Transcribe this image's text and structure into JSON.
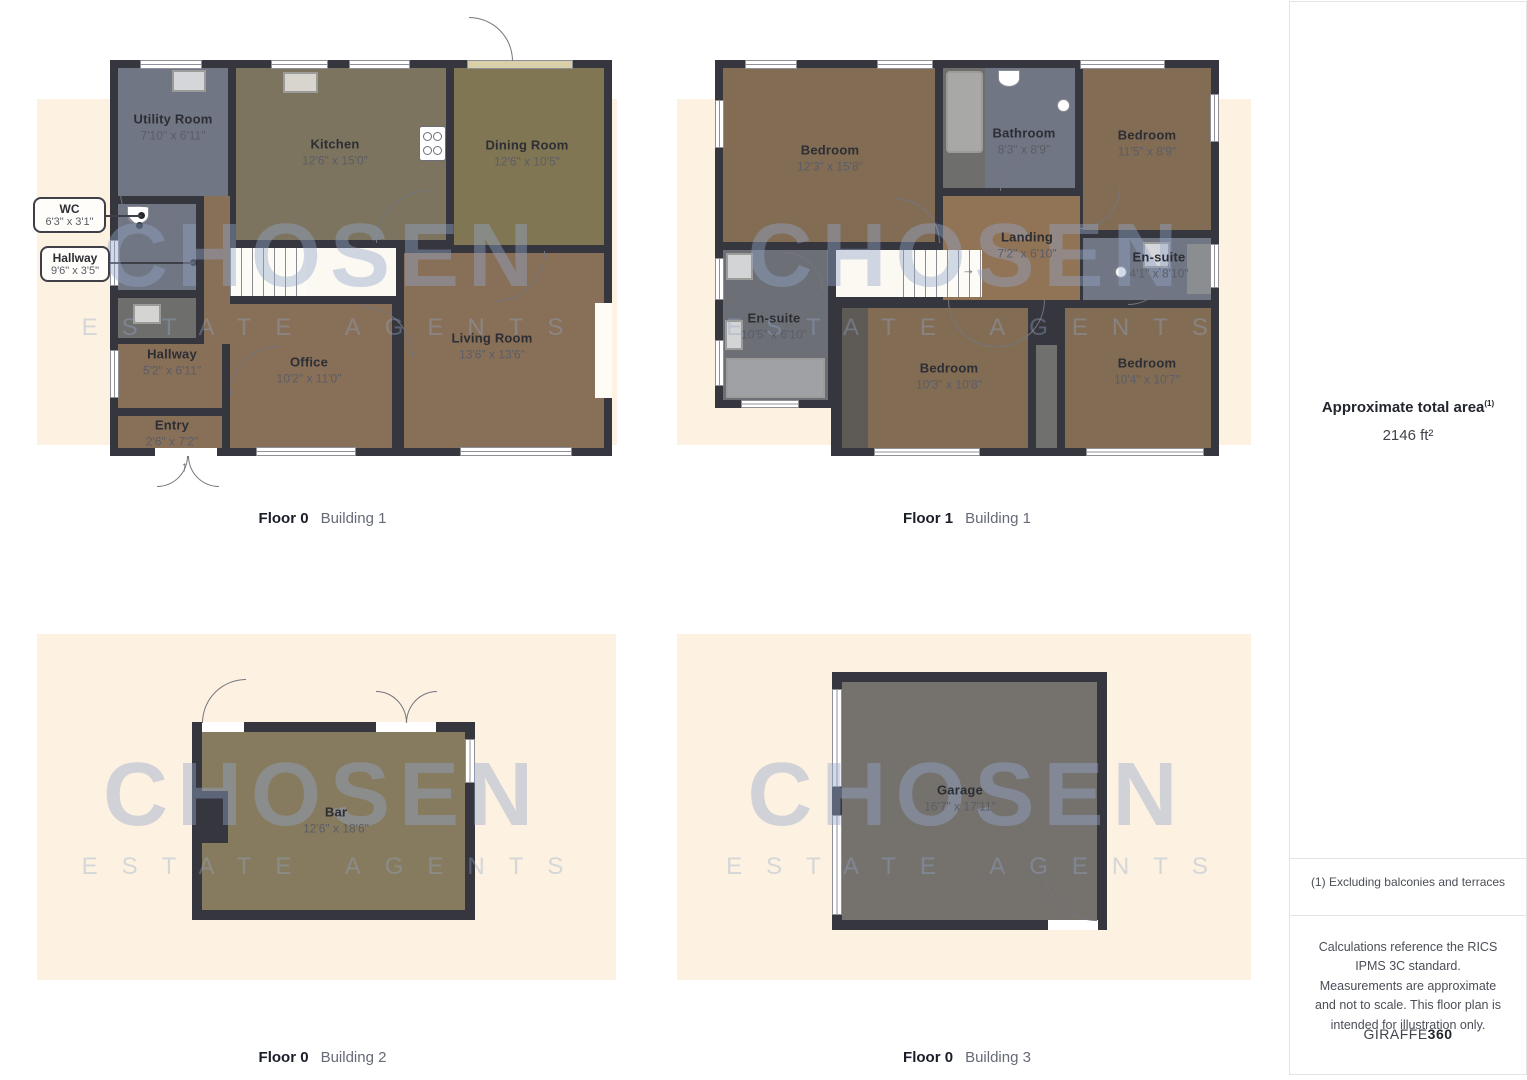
{
  "watermark": {
    "title": "CHOSEN",
    "subtitle": "ESTATE AGENTS"
  },
  "panels": {
    "p1": {
      "caption": {
        "floor": "Floor 0",
        "building": "Building 1"
      },
      "rooms": {
        "utility": {
          "name": "Utility Room",
          "dims": "7'10\" x 6'11\""
        },
        "kitchen": {
          "name": "Kitchen",
          "dims": "12'6\" x 15'0\""
        },
        "dining": {
          "name": "Dining Room",
          "dims": "12'6\" x 10'5\""
        },
        "office": {
          "name": "Office",
          "dims": "10'2\" x 11'0\""
        },
        "living": {
          "name": "Living Room",
          "dims": "13'6\" x 13'6\""
        },
        "hallway": {
          "name": "Hallway",
          "dims": "5'2\" x 6'11\""
        },
        "entry": {
          "name": "Entry",
          "dims": "2'6\" x 7'2\""
        }
      },
      "callouts": {
        "wc": {
          "name": "WC",
          "dims": "6'3\" x 3'1\""
        },
        "hallway2": {
          "name": "Hallway",
          "dims": "9'6\" x 3'5\""
        }
      }
    },
    "p2": {
      "caption": {
        "floor": "Floor 1",
        "building": "Building 1"
      },
      "rooms": {
        "bedroom1": {
          "name": "Bedroom",
          "dims": "12'3\" x 15'8\""
        },
        "bathroom": {
          "name": "Bathroom",
          "dims": "8'3\" x 8'9\""
        },
        "bedroom2": {
          "name": "Bedroom",
          "dims": "11'5\" x 8'9\""
        },
        "landing": {
          "name": "Landing",
          "dims": "7'2\" x 6'10\""
        },
        "ensuite_small": {
          "name": "En-suite",
          "dims": "4'1\" x 8'10\""
        },
        "ensuite_large": {
          "name": "En-suite",
          "dims": "10'5\" x 6'10\""
        },
        "bedroom3": {
          "name": "Bedroom",
          "dims": "10'3\" x 10'8\""
        },
        "bedroom4": {
          "name": "Bedroom",
          "dims": "10'4\" x 10'7\""
        }
      }
    },
    "p3": {
      "caption": {
        "floor": "Floor 0",
        "building": "Building 2"
      },
      "rooms": {
        "bar": {
          "name": "Bar",
          "dims": "12'6\" x 18'6\""
        }
      }
    },
    "p4": {
      "caption": {
        "floor": "Floor 0",
        "building": "Building 3"
      },
      "rooms": {
        "garage": {
          "name": "Garage",
          "dims": "16'7\" x 17'11\""
        }
      }
    }
  },
  "sidebar": {
    "area_title": "Approximate total area",
    "area_footnote_marker": "(1)",
    "area_value": "2146 ft²",
    "footnote": "(1) Excluding balconies and terraces",
    "disclaimer": "Calculations reference the RICS IPMS 3C standard. Measurements are approximate and not to scale. This floor plan is intended for illustration only.",
    "brand": {
      "name": "GIRAFFE",
      "suffix": "360"
    }
  },
  "colors": {
    "wall": "#36363e",
    "backdrop": "#fdf2e1",
    "watermark": "#94a8cb"
  }
}
